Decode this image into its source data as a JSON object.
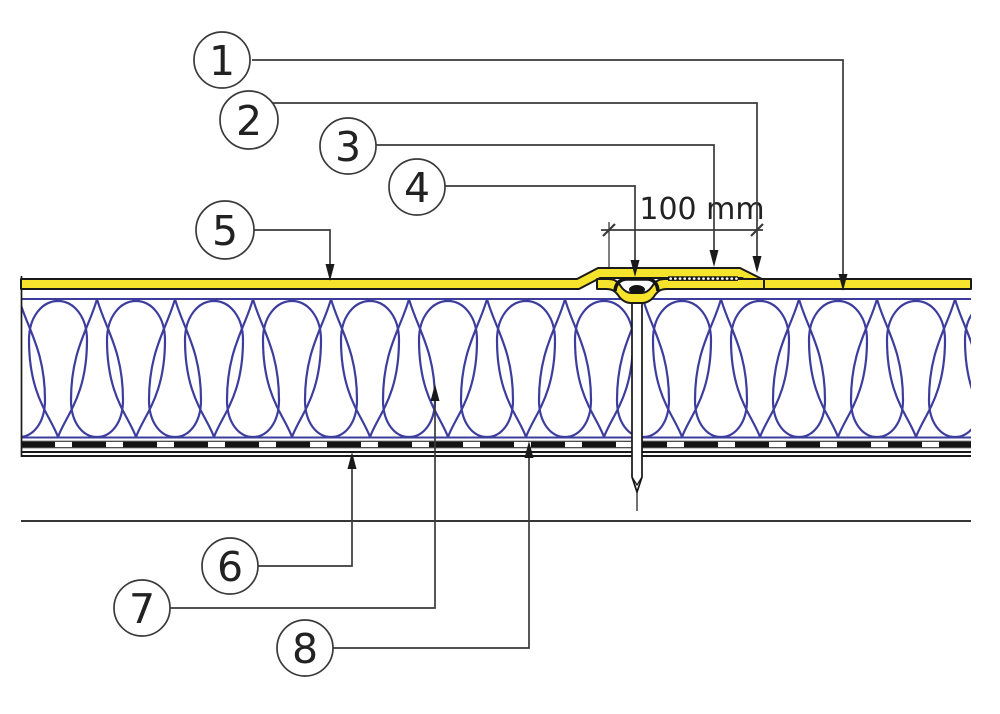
{
  "figure": {
    "background": "#ffffff",
    "colors": {
      "outline": "#1a1a1a",
      "leader": "#3a3a3a",
      "membrane_yellow": "#f6e32c",
      "insulation_blue": "#3d3d9e",
      "label_text": "#222222"
    },
    "callouts": [
      {
        "label": "1"
      },
      {
        "label": "2"
      },
      {
        "label": "3"
      },
      {
        "label": "4"
      },
      {
        "label": "5"
      },
      {
        "label": "6"
      },
      {
        "label": "7"
      },
      {
        "label": "8"
      }
    ],
    "dimension": {
      "label": "100 mm"
    }
  }
}
